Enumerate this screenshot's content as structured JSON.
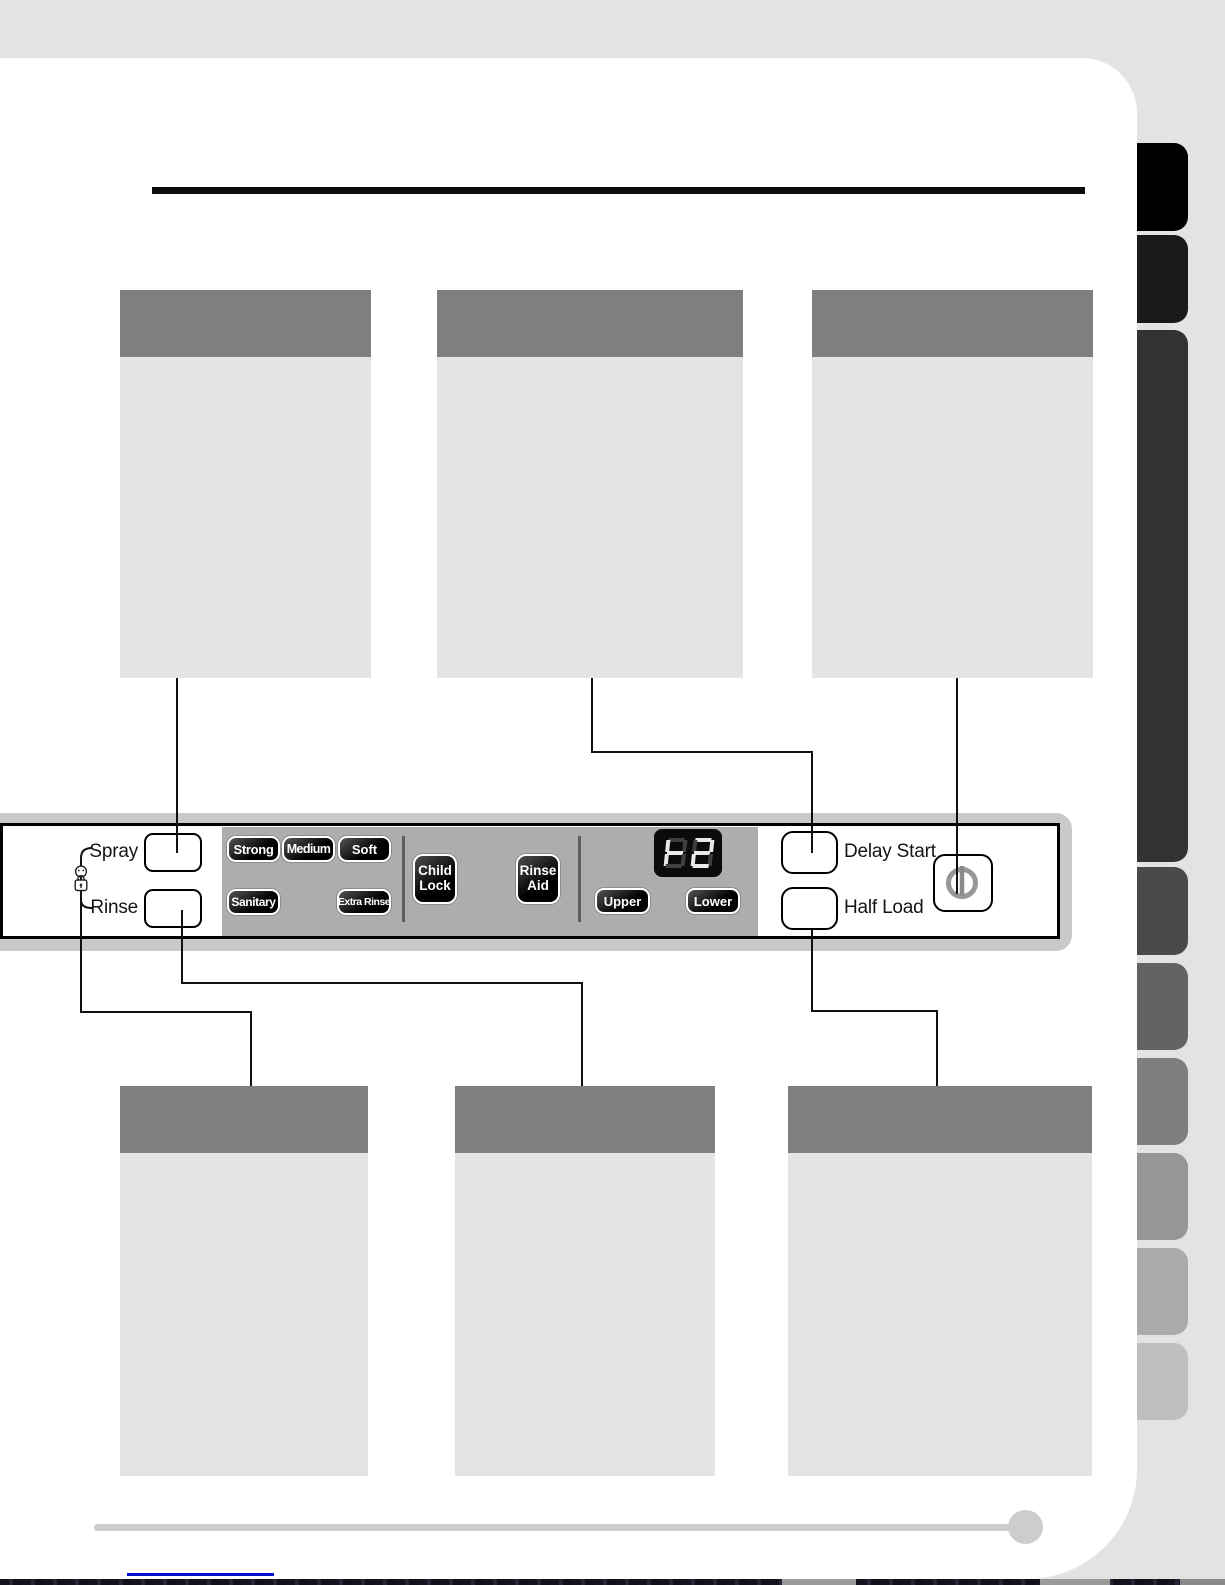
{
  "colors": {
    "background": "#e3e3e3",
    "page_surface": "#ffffff",
    "callout_header": "#7f7f7f",
    "callout_body": "#e4e4e4",
    "panel_band": "#c9c9c9",
    "panel_gray_section": "#adadad",
    "pill_button_dark": "#000000",
    "display_background": "#0b0b0b",
    "display_lit_segment": "#e9e9e9",
    "display_dim_segment": "#3f3f3f",
    "power_glyph": "#979797",
    "connector_line": "#111111",
    "footer_rule": "#cdcdcd",
    "footer_link_line": "#0010cc"
  },
  "sidebar": {
    "tab_colors": [
      "#000000",
      "#1a1a1a",
      "#323232",
      "#4a4a4a",
      "#636363",
      "#7e7e7e",
      "#969696",
      "#aaaaaa",
      "#bfbfbf"
    ]
  },
  "callouts": {
    "top": [
      "callout-1",
      "callout-2",
      "callout-3"
    ],
    "bottom": [
      "callout-4",
      "callout-5",
      "callout-6"
    ]
  },
  "panel": {
    "spray_label": "Spray",
    "rinse_label": "Rinse",
    "wash_options_row1": [
      "Strong",
      "Medium",
      "Soft"
    ],
    "wash_options_row2": [
      "Sanitary",
      "Extra Rinse"
    ],
    "child_lock": {
      "line1": "Child",
      "line2": "Lock"
    },
    "rinse_aid": {
      "line1": "Rinse",
      "line2": "Aid"
    },
    "display_value": "88",
    "rack_options": [
      "Upper",
      "Lower"
    ],
    "delay_start_label": "Delay Start",
    "half_load_label": "Half Load"
  }
}
